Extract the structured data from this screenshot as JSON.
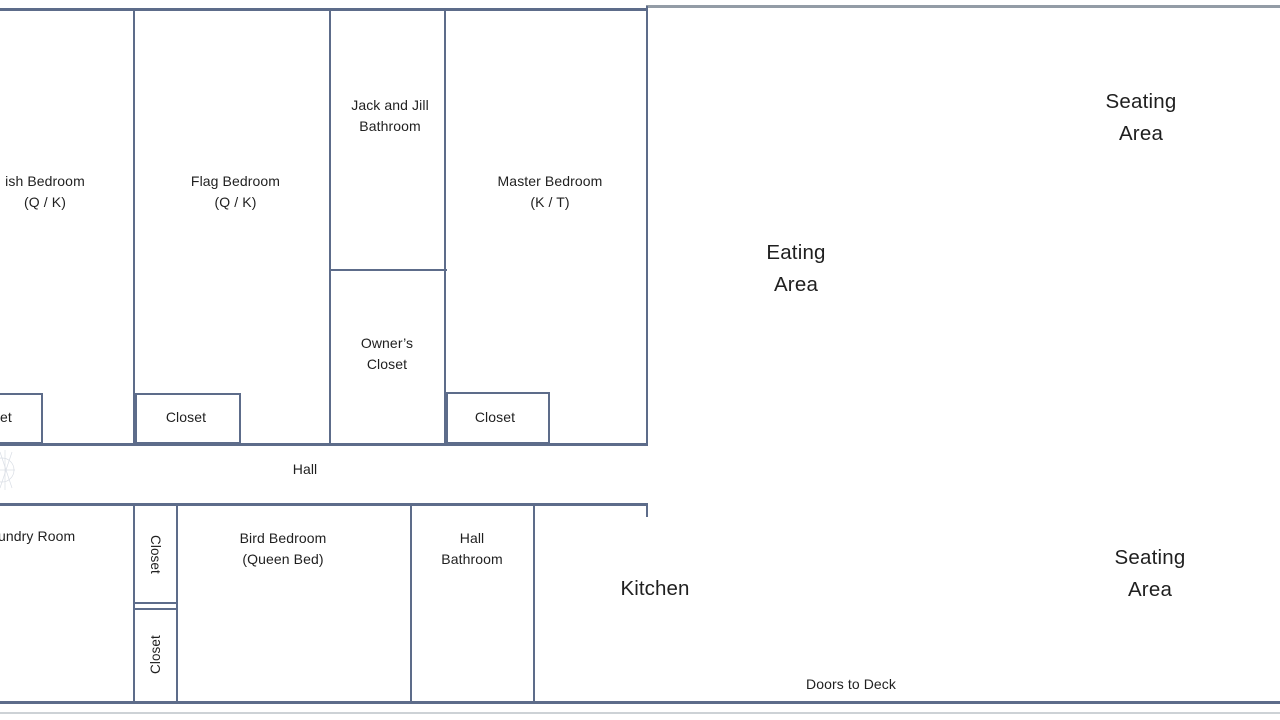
{
  "colors": {
    "wall": "#5d6c8a",
    "wall_gray": "#939ca6",
    "shadow_line": "#cdd2d6",
    "text": "#1f1f1f"
  },
  "plan": {
    "upper_floor": {
      "fish_bedroom_label": "ish Bedroom\n(Q / K)",
      "flag_bedroom_label": "Flag Bedroom\n(Q / K)",
      "jack_and_jill_bathroom_label": "Jack and Jill\nBathroom",
      "master_bedroom_label": "Master Bedroom\n(K / T)",
      "owners_closet_label": "Owner’s\nCloset",
      "cut_closet_label": "et",
      "flag_closet_label": "Closet",
      "master_closet_label": "Closet"
    },
    "hall": {
      "label": "Hall"
    },
    "lower_rooms": {
      "laundry_room_label": "undry Room",
      "upper_closet_label": "Closet",
      "lower_closet_label": "Closet",
      "bird_bedroom_label": "Bird Bedroom\n(Queen Bed)",
      "hall_bathroom_label": "Hall\nBathroom",
      "kitchen_label": "Kitchen",
      "doors_to_deck_label": "Doors to Deck"
    },
    "great_room": {
      "seating_area_top_label": "Seating\nArea",
      "eating_area_label": "Eating\nArea",
      "seating_area_bottom_label": "Seating\nArea"
    }
  }
}
